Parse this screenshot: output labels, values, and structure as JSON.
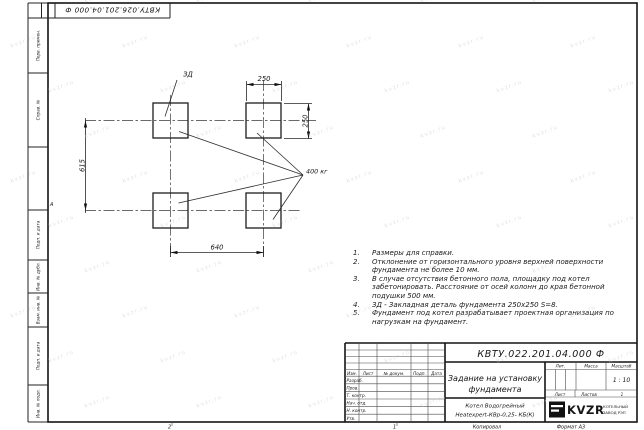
{
  "sheet": {
    "top_doc_number": "КВТУ.026.201.04.000 Ф",
    "zone_letter": "А",
    "zone_number_1": "1",
    "zone_number_2": "2",
    "copied": "Копировал",
    "format": "Формат А3",
    "margin_labels": {
      "perv": "Перв. примен.",
      "sprav": "Справ. №",
      "podp1": "Подп. и дата",
      "inv_dubl": "Инв. № дубл.",
      "vzam": "Взам. инв. №",
      "podp2": "Подп. и дата",
      "inv_podl": "Инв. № подл."
    }
  },
  "drawing": {
    "dim_top": "250",
    "dim_right": "250",
    "dim_left": "615",
    "dim_bottom": "640",
    "weight": "400 кг",
    "embed_label": "ЗД"
  },
  "notes": [
    {
      "n": "1.",
      "t": "Размеры для справки."
    },
    {
      "n": "2.",
      "t": "Отклонение от горизонтального уровня верхней поверхности"
    },
    {
      "n": "",
      "t": "фундамента не более 10 мм."
    },
    {
      "n": "3.",
      "t": "В случае отсутствия бетонного пола, площадку под котел"
    },
    {
      "n": "",
      "t": "забетонировать. Расстояние от осей колонн до края бетонной"
    },
    {
      "n": "",
      "t": "подушки 500 мм."
    },
    {
      "n": "4.",
      "t": "ЗД - Закладная деталь фундамента 250х250 S=8."
    },
    {
      "n": "5.",
      "t": "Фундамент под котел разрабатывает проектная организация по"
    },
    {
      "n": "",
      "t": "нагрузкам на фундамент."
    }
  ],
  "title_block": {
    "doc_number": "КВТУ.022.201.04.000 Ф",
    "title1": "Задание на установку",
    "title2": "фундамента",
    "col_izm": "Изм.",
    "col_list": "Лист",
    "col_doc": "№ докум.",
    "col_podp": "Подп.",
    "col_data": "Дата",
    "row1": "Разраб.",
    "row2": "Пров.",
    "row3": "Т. контр.",
    "row4": "Нач. отд.",
    "row5": "Н. контр.",
    "row6": "Утв.",
    "lit": "Лит.",
    "mass": "Масса",
    "scale": "Масштаб",
    "scale_value": "1 : 10",
    "sheet": "Лист",
    "sheets": "Листов",
    "sheets_value": "1",
    "product1": "Котел Водогрейный",
    "product2": "Heatexpert-КВр-0,25- КБ(К)",
    "brand": "KVZR",
    "brand_sub1": "КОТЕЛЬНЫЙ",
    "brand_sub2": "ЗАВОД РЭП"
  },
  "watermark": {
    "text": "kvzr.ru"
  }
}
